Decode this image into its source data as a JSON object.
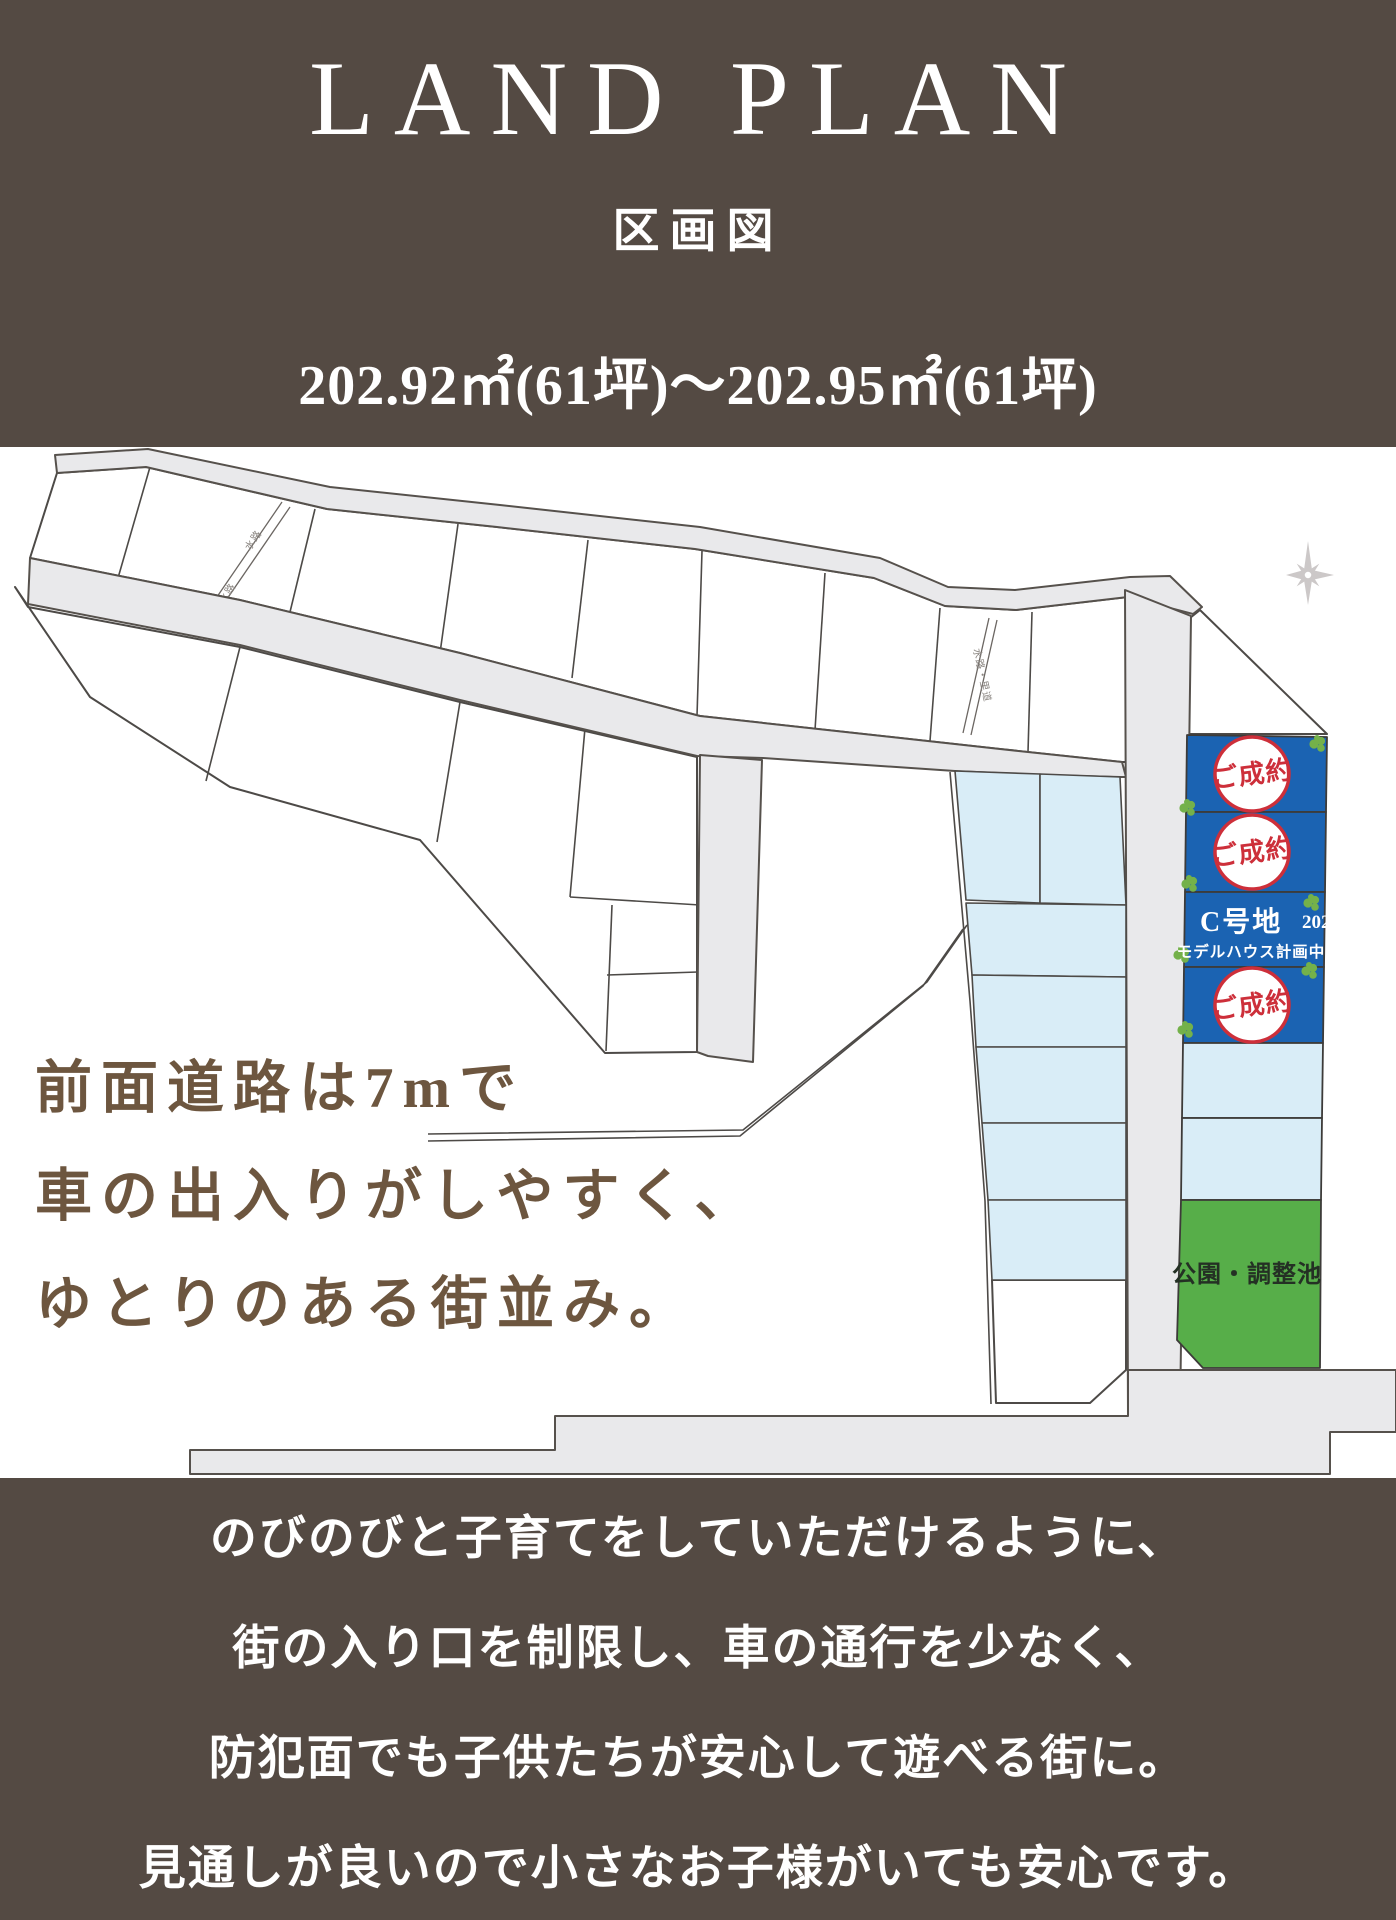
{
  "header": {
    "title": "LAND PLAN",
    "subtitle": "区画図",
    "area_range": "202.92㎡(61坪)〜202.95㎡(61坪)"
  },
  "map": {
    "caption_lines": [
      "前面道路は7mで",
      "車の出入りがしやすく、",
      "ゆとりのある街並み。"
    ],
    "sold_label": "ご成約",
    "lot_c": {
      "name": "C号地",
      "area": "202.92㎡",
      "status": "モデルハウス計画中"
    },
    "park_label": "公園・調整池",
    "waterway_label": "水路",
    "waterway_road_label": "水路・里道",
    "colors": {
      "panel_brown": "#544a43",
      "caption_brown": "#6d563f",
      "lot_blue": "#1b63b2",
      "lot_light_blue": "#d9edf7",
      "park_green": "#57ae49",
      "road_gray": "#e9e9eb",
      "stamp_red": "#cd2f3a",
      "clover_green": "#74b14a"
    }
  },
  "footer": {
    "lines": [
      "のびのびと子育てをしていただけるように、",
      "街の入り口を制限し、車の通行を少なく、",
      "防犯面でも子供たちが安心して遊べる街に。",
      "見通しが良いので小さなお子様がいても安心です。"
    ]
  }
}
